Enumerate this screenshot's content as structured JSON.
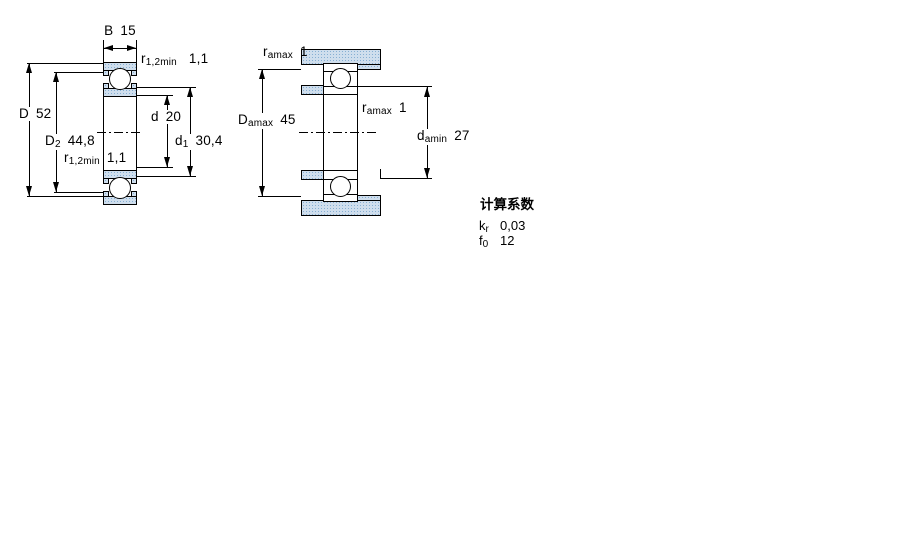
{
  "left_view": {
    "dim_B": {
      "symbol": "B",
      "sub": "",
      "value": "15"
    },
    "dim_r_top": {
      "symbol": "r",
      "sub": "1,2min",
      "value": "1,1"
    },
    "dim_D": {
      "symbol": "D",
      "sub": "",
      "value": "52"
    },
    "dim_D2": {
      "symbol": "D",
      "sub": "2",
      "value": "44,8"
    },
    "dim_d": {
      "symbol": "d",
      "sub": "",
      "value": "20"
    },
    "dim_d1": {
      "symbol": "d",
      "sub": "1",
      "value": "30,4"
    },
    "dim_r_bottom": {
      "symbol": "r",
      "sub": "1,2min",
      "value": "1,1"
    }
  },
  "right_view": {
    "dim_ra_top": {
      "symbol": "r",
      "sub": "amax",
      "value": "1"
    },
    "dim_Da": {
      "symbol": "D",
      "sub": "amax",
      "value": "45"
    },
    "dim_ra_mid": {
      "symbol": "r",
      "sub": "amax",
      "value": "1"
    },
    "dim_da": {
      "symbol": "d",
      "sub": "amin",
      "value": "27"
    }
  },
  "calculation_factors": {
    "title": "计算系数",
    "rows": [
      {
        "symbol": "k",
        "sub": "r",
        "value": "0,03"
      },
      {
        "symbol": "f",
        "sub": "0",
        "value": "12"
      }
    ]
  },
  "colors": {
    "line": "#000000",
    "background": "#ffffff",
    "steel_dot": "#86afd3"
  }
}
